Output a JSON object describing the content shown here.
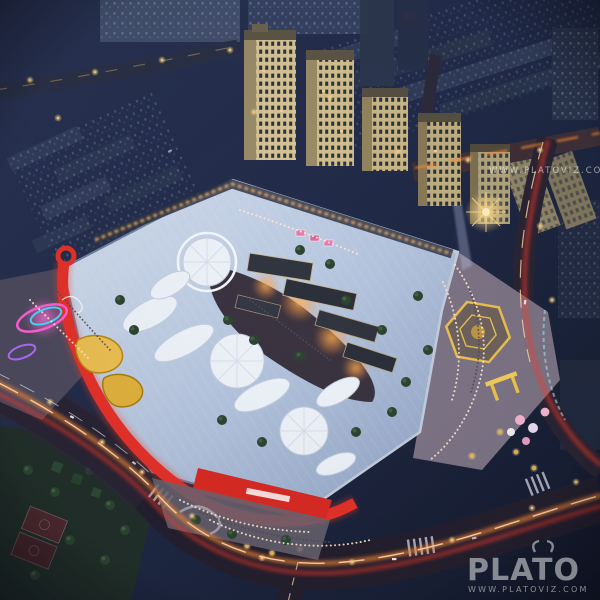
{
  "image": {
    "kind": "night aerial render of an open-air shopping mall with residential towers",
    "style": "architectural visualization"
  },
  "watermarks": {
    "top_right_url": "WWW.PLATOVIZ.COM",
    "brand": "PLATO",
    "brand_url": "WWW.PLATOVIZ.COM"
  },
  "palette": {
    "night_sky": "#232c48",
    "city_building": "#36425f",
    "mall_roof_light": "#cdd9ec",
    "mall_roof_dark": "#93a6c6",
    "canopy_white": "#eef3fa",
    "accent_red": "#e5322a",
    "warm_light": "#ffb357",
    "neon_pink": "#ff5fd1",
    "neon_cyan": "#46d8ff",
    "trail_orange": "#ff8a35",
    "trail_red": "#ff3b26",
    "tower_beige": "#d7c596",
    "plaza_yellow": "#ecc052",
    "park_green": "#22302a",
    "watermark_gray": "#e6e6e6"
  }
}
